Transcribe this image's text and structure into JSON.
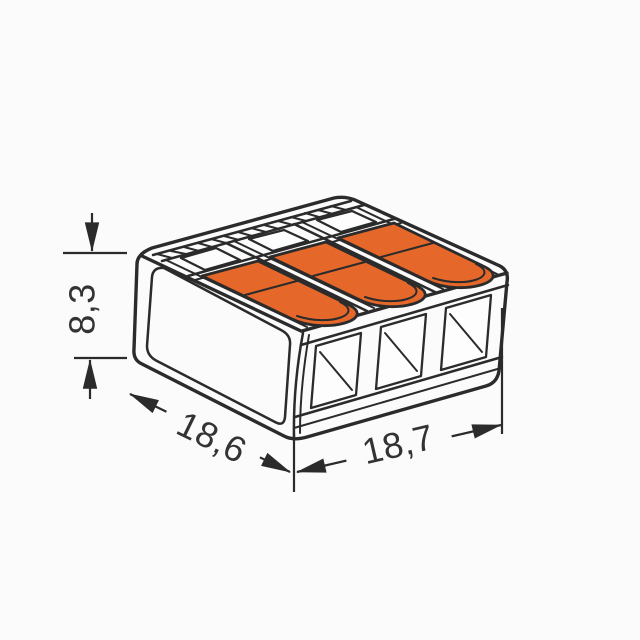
{
  "drawing": {
    "background_color": "#fbfbfb",
    "line_color": "#2b2b2b",
    "lever_color": "#e5682a",
    "lever_count": 3,
    "wire_entry_windows": 3
  },
  "dimensions": {
    "height": {
      "label": "8,3"
    },
    "depth": {
      "label": "18,6"
    },
    "width": {
      "label": "18,7"
    }
  }
}
